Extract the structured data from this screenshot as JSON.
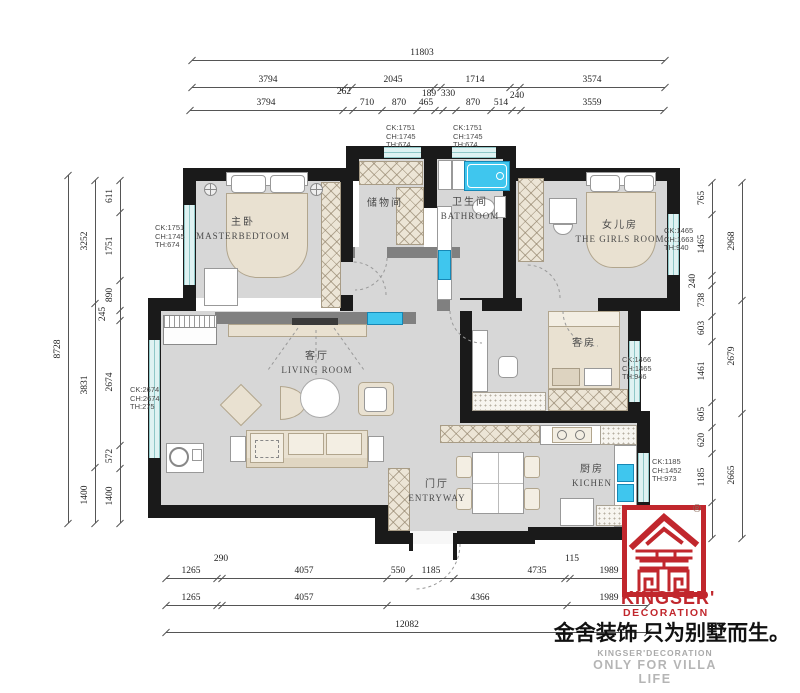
{
  "rooms": {
    "master": {
      "cn": "主卧",
      "en": "MASTERBEDTOOM"
    },
    "storage": {
      "cn": "储物间",
      "en": ""
    },
    "bath": {
      "cn": "卫生间",
      "en": "BATHROOM"
    },
    "girls": {
      "cn": "女儿房",
      "en": "THE GIRLS ROOM"
    },
    "living": {
      "cn": "客厅",
      "en": "LIVING ROOM"
    },
    "guest": {
      "cn": "客房",
      "en": ""
    },
    "kitchen": {
      "cn": "厨房",
      "en": "KICHEN"
    },
    "entry": {
      "cn": "门厅",
      "en": "ENTRYWAY"
    }
  },
  "specs": [
    {
      "l1": "CK:1751",
      "l2": "CH:1745",
      "l3": "TH:674"
    },
    {
      "l1": "CK:1751",
      "l2": "CH:1745",
      "l3": "TH:674"
    },
    {
      "l1": "CK:1751",
      "l2": "CH:1745",
      "l3": "TH:674"
    },
    {
      "l1": "CK:2674",
      "l2": "CH:2674",
      "l3": "TH:275"
    },
    {
      "l1": "CK:1465",
      "l2": "CH:1663",
      "l3": "TH:940"
    },
    {
      "l1": "CK:1466",
      "l2": "CH:1465",
      "l3": "TH:946"
    },
    {
      "l1": "CK:1185",
      "l2": "CH:1452",
      "l3": "TH:973"
    }
  ],
  "dimensions": {
    "h_rows": [
      {
        "y": 60,
        "x1": 192,
        "x2": 665,
        "ticks": [
          192,
          665
        ],
        "labels": [
          {
            "t": "11803",
            "cx": 422
          }
        ]
      },
      {
        "y": 87,
        "x1": 192,
        "x2": 665,
        "ticks": [
          192,
          344,
          352,
          434,
          441,
          510,
          520,
          665
        ],
        "labels": [
          {
            "t": "3794",
            "cx": 268
          },
          {
            "t": "2045",
            "cx": 393
          },
          {
            "t": "1714",
            "cx": 475
          },
          {
            "t": "3574",
            "cx": 592
          }
        ]
      },
      {
        "y": 110,
        "x1": 190,
        "x2": 664,
        "ticks": [
          190,
          343,
          353,
          382,
          417,
          435,
          443,
          456,
          491,
          512,
          521,
          664
        ],
        "labels": [
          {
            "t": "3794",
            "cx": 266
          },
          {
            "t": "710",
            "cx": 367
          },
          {
            "t": "870",
            "cx": 399
          },
          {
            "t": "465",
            "cx": 426
          },
          {
            "t": "870",
            "cx": 473
          },
          {
            "t": "514",
            "cx": 501
          },
          {
            "t": "3559",
            "cx": 592
          }
        ]
      },
      {
        "y": 578,
        "x1": 166,
        "x2": 648,
        "ticks": [
          166,
          217,
          222,
          387,
          409,
          454,
          565,
          570,
          648
        ],
        "labels": [
          {
            "t": "1265",
            "cx": 191
          },
          {
            "t": "4057",
            "cx": 304
          },
          {
            "t": "550",
            "cx": 398
          },
          {
            "t": "1185",
            "cx": 431
          },
          {
            "t": "4735",
            "cx": 537
          },
          {
            "t": "1989",
            "cx": 609
          }
        ]
      },
      {
        "y": 605,
        "x1": 166,
        "x2": 648,
        "ticks": [
          166,
          217,
          222,
          387,
          567,
          648
        ],
        "labels": [
          {
            "t": "1265",
            "cx": 191
          },
          {
            "t": "4057",
            "cx": 304
          },
          {
            "t": "4366",
            "cx": 480
          },
          {
            "t": "1989",
            "cx": 609
          }
        ]
      },
      {
        "y": 632,
        "x1": 166,
        "x2": 648,
        "ticks": [
          166,
          648
        ],
        "labels": [
          {
            "t": "12082",
            "cx": 407
          }
        ]
      }
    ],
    "v_cols": [
      {
        "x": 68,
        "y1": 175,
        "y2": 523,
        "ticks": [
          175,
          523
        ],
        "labels": [
          {
            "t": "8728",
            "cy": 349
          }
        ]
      },
      {
        "x": 95,
        "y1": 180,
        "y2": 523,
        "ticks": [
          180,
          303,
          467,
          523
        ],
        "labels": [
          {
            "t": "3252",
            "cy": 241
          },
          {
            "t": "3831",
            "cy": 385
          },
          {
            "t": "1400",
            "cy": 495
          }
        ]
      },
      {
        "x": 120,
        "y1": 180,
        "y2": 523,
        "ticks": [
          180,
          212,
          280,
          310,
          320,
          445,
          468,
          523
        ],
        "labels": [
          {
            "t": "611",
            "cy": 196
          },
          {
            "t": "1751",
            "cy": 246
          },
          {
            "t": "890",
            "cy": 295
          },
          {
            "t": "2674",
            "cy": 382
          },
          {
            "t": "572",
            "cy": 456
          },
          {
            "t": "1400",
            "cy": 496
          }
        ]
      },
      {
        "x": 712,
        "y1": 182,
        "y2": 538,
        "ticks": [
          182,
          214,
          275,
          285,
          316,
          341,
          402,
          427,
          453,
          502,
          538
        ],
        "labels": [
          {
            "t": "765",
            "cy": 198
          },
          {
            "t": "1465",
            "cy": 244
          },
          {
            "t": "738",
            "cy": 300
          },
          {
            "t": "603",
            "cy": 328
          },
          {
            "t": "1461",
            "cy": 371
          },
          {
            "t": "605",
            "cy": 414
          },
          {
            "t": "620",
            "cy": 440
          },
          {
            "t": "1185",
            "cy": 477
          },
          {
            "t": "860",
            "cy": 520
          }
        ]
      },
      {
        "x": 742,
        "y1": 182,
        "y2": 538,
        "ticks": [
          182,
          300,
          413,
          538
        ],
        "labels": [
          {
            "t": "2968",
            "cy": 241
          },
          {
            "t": "2679",
            "cy": 356
          },
          {
            "t": "2665",
            "cy": 475
          }
        ]
      }
    ],
    "raised": [
      {
        "t": "262",
        "x": 344,
        "y": 93
      },
      {
        "t": "189",
        "x": 429,
        "y": 95
      },
      {
        "t": "330",
        "x": 448,
        "y": 95
      },
      {
        "t": "240",
        "x": 517,
        "y": 97
      },
      {
        "t": "290",
        "x": 221,
        "y": 560
      },
      {
        "t": "115",
        "x": 572,
        "y": 560
      },
      {
        "t": "245",
        "x": 104,
        "y": 314,
        "rot": true
      },
      {
        "t": "240",
        "x": 694,
        "y": 281,
        "rot": true
      }
    ]
  },
  "logo": {
    "brand": "KINGSER'",
    "division": "DECORATION",
    "registered": "®",
    "slogan": "金舍装饰 只为别墅而生。",
    "caption_en": "KINGSER'DECORATION",
    "caption_sub": "ONLY FOR VILLA LIFE"
  },
  "colors": {
    "logo_red": "#c1272d",
    "fixture_cyan": "#3fc6ee",
    "window_cyan": "#dff2f2",
    "wall_black": "#1a1a1a",
    "wall_gray": "#808080",
    "floor_gray": "#d7d7d7",
    "furniture_beige": "#e9e1d1"
  }
}
